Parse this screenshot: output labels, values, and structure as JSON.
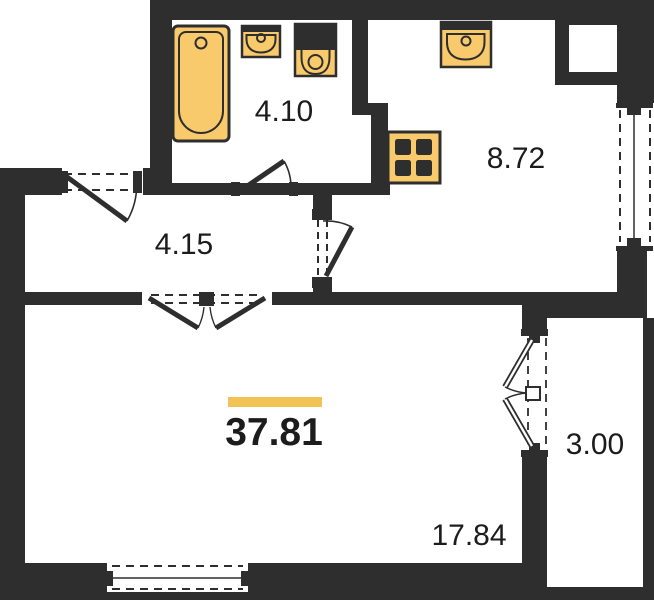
{
  "floorplan": {
    "total_area": "37.81",
    "rooms": [
      {
        "id": "bathroom",
        "area": "4.10"
      },
      {
        "id": "hallway",
        "area": "4.15"
      },
      {
        "id": "kitchen",
        "area": "8.72"
      },
      {
        "id": "living_room",
        "area": "17.84"
      },
      {
        "id": "balcony",
        "area": "3.00"
      }
    ],
    "fixtures": [
      {
        "id": "bathtub"
      },
      {
        "id": "washbasin"
      },
      {
        "id": "toilet"
      },
      {
        "id": "kitchen_sink"
      },
      {
        "id": "stove"
      }
    ],
    "colors": {
      "wall": "#2e2e2e",
      "fixture_fill": "#F8CA6B",
      "fixture_outline": "#2e2e2e",
      "accent_bar": "#F2C254",
      "text": "#1c1c1c",
      "background": "#ffffff"
    }
  }
}
